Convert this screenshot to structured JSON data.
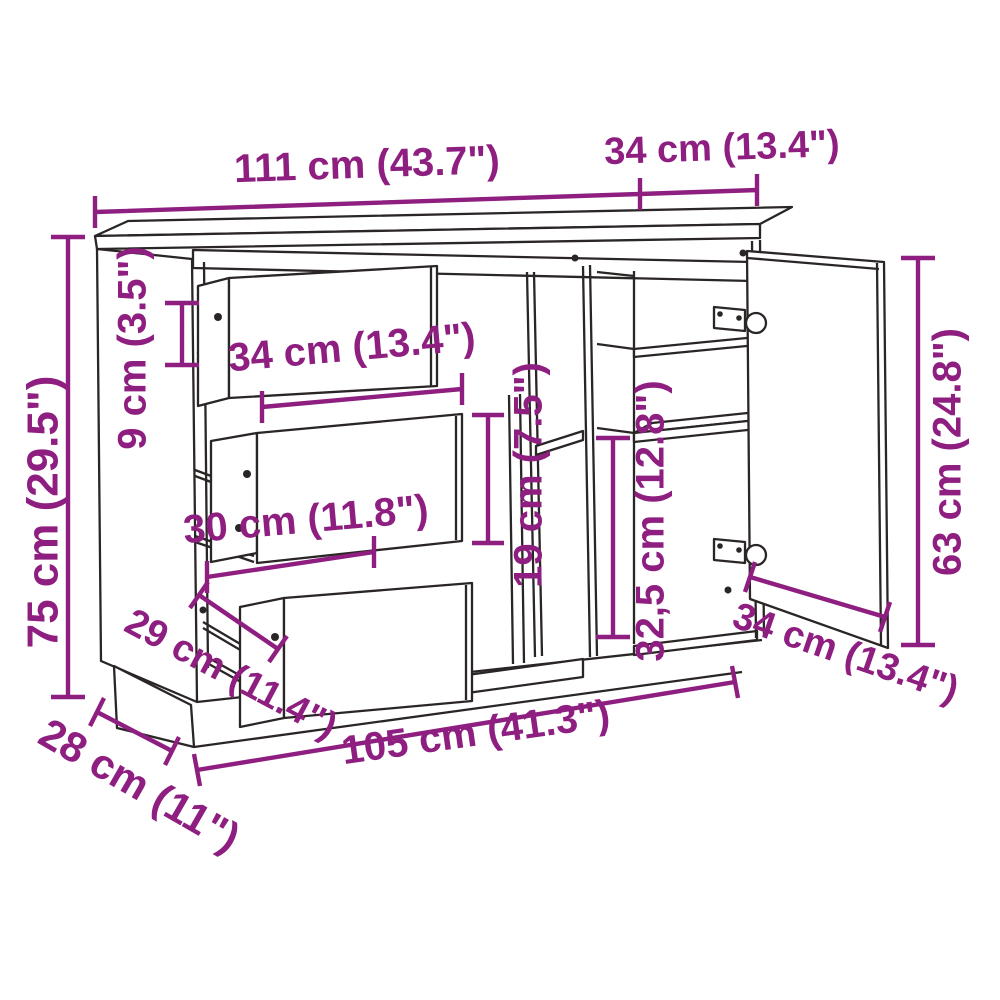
{
  "diagram": {
    "kind": "furniture-dimension-drawing",
    "subject": "sideboard with three drawers, open shelf compartment and hinged door",
    "background_color": "#ffffff",
    "line_color": "#2b2626",
    "dimension_color": "#8E1F80",
    "dimensions": [
      {
        "id": "overall-width",
        "label": "111 cm (43.7\")"
      },
      {
        "id": "top-depth",
        "label": "34 cm (13.4\")"
      },
      {
        "id": "overall-height",
        "label": "75 cm (29.5\")"
      },
      {
        "id": "top-gap-height",
        "label": "9 cm (3.5\")"
      },
      {
        "id": "drawer-front-width",
        "label": "34 cm (13.4\")"
      },
      {
        "id": "drawer-inner-width",
        "label": "30 cm (11.8\")"
      },
      {
        "id": "drawer-depth",
        "label": "29 cm (11.4\")"
      },
      {
        "id": "base-depth",
        "label": "28 cm (11\")"
      },
      {
        "id": "base-width",
        "label": "105 cm (41.3\")"
      },
      {
        "id": "shelf-gap-height",
        "label": "19 cm (7.5\")"
      },
      {
        "id": "compartment-height",
        "label": "32,5 cm (12.8\")"
      },
      {
        "id": "door-height",
        "label": "63 cm (24.8\")"
      },
      {
        "id": "door-width",
        "label": "34 cm (13.4\")"
      }
    ]
  }
}
